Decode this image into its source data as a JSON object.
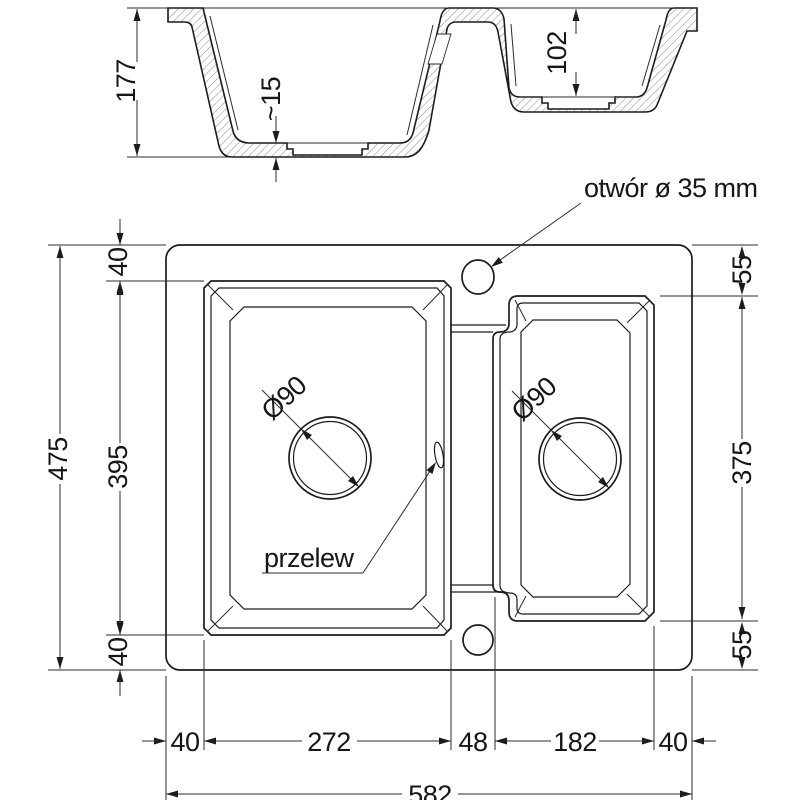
{
  "section_view": {
    "total_height": "177",
    "right_bowl_depth": "102",
    "floor_thickness": "~15"
  },
  "plan_view": {
    "annotations": {
      "faucet_hole": "otwór ø 35 mm",
      "overflow": "przelew",
      "drain_left": "Ø90",
      "drain_right": "Ø90"
    },
    "left_dims": {
      "top_offset": "40",
      "bowl_length": "395",
      "bottom_offset": "40",
      "total_length": "475"
    },
    "right_dims": {
      "top_offset": "55",
      "bowl_length": "375",
      "bottom_offset": "55"
    },
    "bottom_dims": {
      "left_offset": "40",
      "left_bowl_width": "272",
      "divider_width": "48",
      "right_bowl_width": "182",
      "right_offset": "40",
      "total_width": "582"
    },
    "colors": {
      "line": "#1c1c1c",
      "background": "#ffffff"
    }
  }
}
